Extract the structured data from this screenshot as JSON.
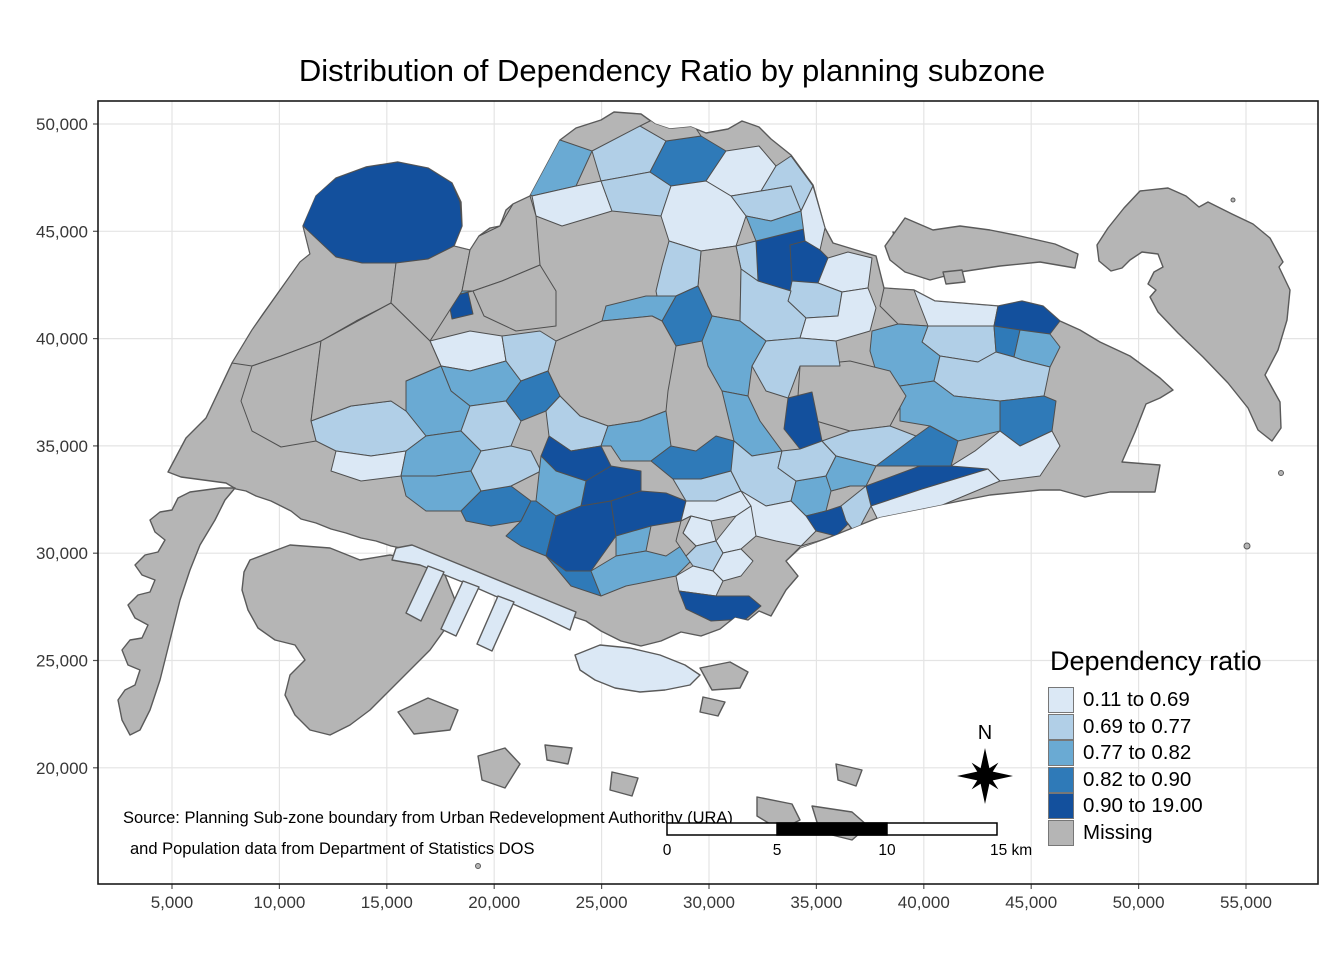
{
  "title": "Distribution of Dependency Ratio by planning subzone",
  "axes": {
    "x_ticks": [
      "5,000",
      "10,000",
      "15,000",
      "20,000",
      "25,000",
      "30,000",
      "35,000",
      "40,000",
      "45,000",
      "50,000",
      "55,000"
    ],
    "y_ticks": [
      "50,000",
      "45,000",
      "40,000",
      "35,000",
      "30,000",
      "25,000",
      "20,000"
    ]
  },
  "legend": {
    "title": "Dependency ratio",
    "items": [
      {
        "label": "0.11 to 0.69",
        "color": "#dbe8f5"
      },
      {
        "label": "0.69 to 0.77",
        "color": "#b1cfe7"
      },
      {
        "label": "0.77 to 0.82",
        "color": "#6aaad3"
      },
      {
        "label": "0.82 to 0.90",
        "color": "#2f7ab8"
      },
      {
        "label": "0.90 to 19.00",
        "color": "#13509d"
      },
      {
        "label": "Missing",
        "color": "#b5b5b5"
      }
    ]
  },
  "annotations": {
    "source_line1": "Source: Planning Sub-zone boundary from Urban Redevelopment Authorithy (URA)",
    "source_line2": "and Population data from Department of Statistics DOS",
    "north_label": "N",
    "scalebar_labels": [
      "0",
      "5",
      "10",
      "15 km"
    ]
  },
  "map": {
    "palette": {
      "c1": "#dbe8f5",
      "c2": "#b1cfe7",
      "c3": "#6aaad3",
      "c4": "#2f7ab8",
      "c5": "#13509d",
      "na": "#b5b5b5"
    },
    "land_stroke": "#5a5a5a",
    "subzone_stroke": "#4f4f4f",
    "grid_color": "#e4e4e4",
    "border_color": "#1a1a1a",
    "islands": [
      {
        "name": "main-island",
        "c": "na",
        "p": "168,472 186,438 206,418 232,363 252,330 263,314 300,262 310,254 303,226 316,196 336,178 366,167 398,162 428,168 452,183 461,202 462,226 454,246 470,250 479,236 490,228 500,226 506,210 513,204 530,196 560,140 576,128 601,120 614,112 641,114 655,124 670,129 691,127 706,133 728,129 742,121 759,127 771,139 791,155 813,185 825,228 833,243 856,250 876,256 884,288 914,290 935,301 998,306 1022,301 1043,306 1060,321 1080,330 1100,342 1130,356 1160,378 1173,390 1160,398 1146,404 1135,432 1122,462 1160,465 1155,492 1110,492 1085,497 1060,490 1040,490 990,495 940,505 880,517 830,537 800,548 786,561 798,576 786,590 771,616 759,611 748,620 735,617 720,629 701,636 681,632 661,641 641,646 621,641 601,631 586,621 571,616 556,606 541,601 526,599 511,591 496,586 481,579 466,573 451,569 436,561 421,556 406,549 391,546 376,541 361,538 346,533 331,529 316,523 301,519 291,511 281,506 271,501 256,496 246,491 236,489 226,483 211,481 196,479 181,477"
      },
      {
        "name": "tuas",
        "c": "na",
        "p": "235,488 220,488 205,490 190,492 178,498 172,510 160,512 150,520 155,532 165,540 158,552 145,555 135,565 142,575 155,580 150,592 138,595 128,605 135,618 148,625 142,638 130,640 122,650 128,665 140,670 135,685 125,690 118,700 122,720 130,735 140,730 150,710 160,680 170,640 180,600 190,570 200,545 215,520 225,500"
      },
      {
        "name": "jurong-island",
        "c": "na",
        "p": "250,560 290,545 330,548 360,560 390,555 420,560 445,575 455,600 448,625 430,650 410,670 390,690 370,710 350,725 330,735 310,730 295,715 285,695 290,675 305,660 295,645 275,640 258,628 248,610 242,590 244,572"
      },
      {
        "name": "sentosa",
        "c": "c1",
        "p": "575,655 600,645 630,648 660,655 685,665 700,675 690,685 665,690 640,692 615,688 595,680 580,670"
      },
      {
        "name": "pier-spine",
        "c": "c1",
        "p": "396,548 412,545 576,612 570,630 545,618 470,585 420,565 392,560"
      },
      {
        "name": "pier-1",
        "c": "c1",
        "p": "428,566 444,572 421,621 406,613"
      },
      {
        "name": "pier-2",
        "c": "c1",
        "p": "463,581 479,587 456,636 441,629"
      },
      {
        "name": "pier-3",
        "c": "c1",
        "p": "498,596 514,602 492,651 477,644"
      },
      {
        "name": "coney",
        "c": "na",
        "p": "893,232 933,247 926,256 896,243"
      },
      {
        "name": "pulau-ubin",
        "c": "na",
        "p": "885,246 905,218 933,230 960,226 990,230 1020,236 1055,244 1078,254 1075,268 1040,262 1000,266 960,272 930,280 905,272 890,260"
      },
      {
        "name": "ubin-islet",
        "c": "na",
        "p": "943,272 962,270 965,282 946,284"
      },
      {
        "name": "pulau-tekong",
        "c": "na",
        "p": "1140,191 1168,188 1186,196 1199,207 1208,202 1232,214 1253,224 1270,238 1283,262 1279,267 1290,290 1287,320 1278,350 1265,375 1280,402 1281,428 1272,441 1258,430 1248,408 1228,383 1203,357 1178,333 1158,312 1150,297 1156,290 1148,284 1154,272 1163,267 1158,254 1142,252 1130,260 1122,268 1111,271 1099,261 1097,245 1108,228 1124,208"
      },
      {
        "name": "south-island-1",
        "c": "na",
        "p": "398,712 428,698 458,710 450,730 414,734"
      },
      {
        "name": "south-island-2",
        "c": "na",
        "p": "478,756 505,748 520,764 505,788 482,780"
      },
      {
        "name": "south-island-3",
        "c": "na",
        "p": "545,745 572,748 568,764 547,760"
      },
      {
        "name": "south-island-4",
        "c": "na",
        "p": "612,772 638,778 632,796 610,790"
      },
      {
        "name": "south-island-5",
        "c": "na",
        "p": "700,668 730,662 748,672 740,688 712,690"
      },
      {
        "name": "south-island-6",
        "c": "na",
        "p": "703,697 725,702 718,716 700,712"
      },
      {
        "name": "south-island-7",
        "c": "na",
        "p": "757,797 792,804 800,820 780,830 757,816"
      },
      {
        "name": "south-island-8",
        "c": "na",
        "p": "812,806 852,812 868,826 852,840 820,832"
      },
      {
        "name": "south-island-9",
        "c": "na",
        "p": "836,764 862,770 856,786 838,780"
      }
    ],
    "islet_dots": [
      {
        "x": 1233,
        "y": 200,
        "r": 2
      },
      {
        "x": 1281,
        "y": 473,
        "r": 2.5
      },
      {
        "x": 1247,
        "y": 546,
        "r": 3
      },
      {
        "x": 478,
        "y": 866,
        "r": 2.5
      }
    ],
    "subzones": [
      {
        "c": "c5",
        "p": "302,228 315,196 336,178 366,167 398,162 428,168 452,183 460,202 462,226 454,246 428,259 396,263 362,263 336,257 316,247"
      },
      {
        "c": "c5",
        "p": "448,298 468,292 473,314 452,319"
      },
      {
        "c": "c3",
        "p": "449,274 470,268 473,291 451,296"
      },
      {
        "c": "c3",
        "p": "506,172 560,140 592,151 576,186 532,196"
      },
      {
        "c": "c2",
        "p": "592,151 640,126 666,141 650,172 601,181"
      },
      {
        "c": "c1",
        "p": "532,196 576,186 601,181 612,211 562,226 536,216"
      },
      {
        "c": "c2",
        "p": "601,181 650,172 671,186 661,216 612,211"
      },
      {
        "c": "c4",
        "p": "650,172 666,141 701,136 726,151 706,181 671,186"
      },
      {
        "c": "na",
        "p": "640,126 660,116 691,121 701,136 666,141"
      },
      {
        "c": "c1",
        "p": "706,181 726,151 759,146 776,166 761,191 731,196"
      },
      {
        "c": "c2",
        "p": "761,191 776,166 791,156 813,186 801,211 791,186"
      },
      {
        "c": "c2",
        "p": "731,196 761,191 791,186 801,211 771,221 746,216"
      },
      {
        "c": "c1",
        "p": "661,216 671,186 706,181 731,196 746,216 736,246 701,251 669,241"
      },
      {
        "c": "c5",
        "p": "756,241 816,226 818,276 791,291 758,281"
      },
      {
        "c": "c3",
        "p": "746,216 771,221 801,211 816,226 756,241"
      },
      {
        "c": "c2",
        "p": "736,246 756,241 758,281 741,269"
      },
      {
        "c": "c1",
        "p": "801,211 813,186 825,228 820,250 805,241"
      },
      {
        "c": "c5",
        "p": "790,245 805,241 820,250 828,258 818,283 792,281"
      },
      {
        "c": "c1",
        "p": "818,283 828,258 848,252 872,258 868,288 842,292"
      },
      {
        "c": "c2",
        "p": "792,281 818,283 842,292 838,316 806,318 788,301"
      },
      {
        "c": "na",
        "p": "701,251 736,246 741,269 740,321 712,316 698,286"
      },
      {
        "c": "c2",
        "p": "740,321 741,269 758,281 791,291 788,301 806,318 800,338 766,341"
      },
      {
        "c": "c1",
        "p": "806,318 838,316 842,292 868,288 876,308 870,331 836,341 800,338"
      },
      {
        "c": "na",
        "p": "884,288 914,290 935,301 928,326 898,324 880,306"
      },
      {
        "c": "c1",
        "p": "914,290 935,301 998,306 994,326 928,326"
      },
      {
        "c": "c5",
        "p": "998,306 1022,301 1043,306 1060,321 1050,334 1020,330 994,326"
      },
      {
        "c": "c2",
        "p": "928,326 994,326 996,352 978,362 940,356 922,342"
      },
      {
        "c": "c4",
        "p": "994,326 1020,330 1014,357 996,352"
      },
      {
        "c": "c3",
        "p": "1020,330 1050,334 1060,347 1050,367 1022,360 1014,357"
      },
      {
        "c": "c3",
        "p": "898,324 928,326 922,342 940,356 934,381 900,386 876,371 870,351 872,331"
      },
      {
        "c": "c2",
        "p": "940,356 978,362 996,352 1014,357 1022,360 1050,367 1044,396 1000,401 954,396 934,381"
      },
      {
        "c": "c3",
        "p": "934,381 954,396 1000,401 1000,431 958,441 930,426 900,421 900,386"
      },
      {
        "c": "c4",
        "p": "1000,401 1044,396 1056,401 1052,431 1020,446 1000,431"
      },
      {
        "c": "na",
        "p": "800,366 850,361 890,371 906,396 890,426 850,431 816,421 798,396"
      },
      {
        "c": "c5",
        "p": "788,398 812,392 822,441 800,449 784,429"
      },
      {
        "c": "c2",
        "p": "766,341 800,338 836,341 840,366 800,366 788,398 766,391 752,366"
      },
      {
        "c": "c3",
        "p": "712,316 740,321 766,341 752,366 748,396 722,391 708,366 702,341"
      },
      {
        "c": "c3",
        "p": "722,391 748,396 760,421 782,451 752,456 734,441"
      },
      {
        "c": "c2",
        "p": "669,241 701,251 698,286 676,296 662,321 656,291 662,266"
      },
      {
        "c": "c4",
        "p": "676,296 698,286 712,316 702,341 676,346 662,321"
      },
      {
        "c": "c3",
        "p": "606,306 646,296 676,296 662,321 652,316 602,321"
      },
      {
        "c": "na",
        "p": "556,341 602,321 652,316 662,321 676,346 668,391 666,411 640,421 608,426 580,416 560,396 548,371"
      },
      {
        "c": "c1",
        "p": "430,341 470,331 502,336 506,361 470,371 441,366"
      },
      {
        "c": "c3",
        "p": "441,366 470,371 506,361 521,381 506,401 470,406 451,391"
      },
      {
        "c": "c2",
        "p": "502,336 540,331 556,341 548,371 521,381 506,361"
      },
      {
        "c": "c3",
        "p": "406,381 441,366 451,391 470,406 461,431 426,436 406,411"
      },
      {
        "c": "c2",
        "p": "461,431 470,406 506,401 521,421 511,446 481,451"
      },
      {
        "c": "c4",
        "p": "521,381 548,371 560,396 546,411 521,421 506,401"
      },
      {
        "c": "c2",
        "p": "311,421 351,406 391,401 406,411 426,436 406,451 371,456 336,451 316,441"
      },
      {
        "c": "c1",
        "p": "336,451 371,456 406,451 401,476 361,481 331,471"
      },
      {
        "c": "c3",
        "p": "406,451 426,436 461,431 481,451 471,471 436,476 401,476"
      },
      {
        "c": "c3",
        "p": "401,476 436,476 471,471 481,491 461,511 426,511 406,496"
      },
      {
        "c": "c4",
        "p": "461,511 481,491 511,486 531,501 521,521 491,526 466,521"
      },
      {
        "c": "c2",
        "p": "481,451 511,446 531,451 541,471 511,486 481,491 471,471"
      },
      {
        "c": "c2",
        "p": "546,411 560,396 580,416 608,426 601,446 571,451 549,436"
      },
      {
        "c": "c5",
        "p": "549,436 571,451 601,446 611,466 586,481 556,471 541,456"
      },
      {
        "c": "c3",
        "p": "608,426 640,421 666,411 671,446 651,461 621,461 611,446 601,446"
      },
      {
        "c": "c5",
        "p": "586,481 611,466 641,471 641,491 611,501 581,506"
      },
      {
        "c": "c3",
        "p": "541,456 556,471 586,481 581,506 556,516 536,501"
      },
      {
        "c": "c4",
        "p": "531,501 536,501 556,516 546,556 521,546 506,536 521,521"
      },
      {
        "c": "c5",
        "p": "556,516 581,506 611,501 616,536 591,571 566,571 546,556"
      },
      {
        "c": "c5",
        "p": "611,501 641,491 666,493 686,501 681,521 651,526 616,536"
      },
      {
        "c": "c3",
        "p": "616,536 651,526 646,551 616,556"
      },
      {
        "c": "c4",
        "p": "546,556 566,571 591,571 601,596 571,586"
      },
      {
        "c": "c3",
        "p": "591,571 616,556 646,551 666,556 681,546 691,561 676,576 651,581 626,586 601,596"
      },
      {
        "c": "c4",
        "p": "651,461 671,446 696,451 716,436 734,441 752,456 731,471 701,479 673,479"
      },
      {
        "c": "c2",
        "p": "673,479 701,479 731,471 741,491 716,501 686,501"
      },
      {
        "c": "c1",
        "p": "686,501 716,501 741,491 751,506 736,516 711,521 691,516 681,521"
      },
      {
        "c": "c1",
        "p": "691,516 711,521 716,541 696,546 683,533"
      },
      {
        "c": "c1",
        "p": "716,541 736,516 751,506 766,516 756,536 741,549 723,553"
      },
      {
        "c": "c2",
        "p": "696,546 716,541 723,553 713,571 693,566 686,556"
      },
      {
        "c": "c1",
        "p": "713,571 723,553 741,549 753,561 741,576 723,581"
      },
      {
        "c": "na",
        "p": "681,521 691,516 683,533 696,546 686,556 676,541"
      },
      {
        "c": "c1",
        "p": "676,576 693,566 713,571 723,581 716,596 679,591"
      },
      {
        "c": "c5",
        "p": "679,591 716,596 749,596 761,606 746,619 711,621 686,609"
      },
      {
        "c": "c2",
        "p": "731,471 734,441 752,456 782,451 778,468 796,481 791,501 766,506 741,491"
      },
      {
        "c": "c3",
        "p": "796,481 826,476 836,456 856,461 850,486 831,491 826,511 806,516 791,501"
      },
      {
        "c": "c5",
        "p": "806,516 826,511 841,506 851,521 836,536 816,531"
      },
      {
        "c": "c1",
        "p": "741,491 766,506 791,501 806,516 816,531 801,546 776,541 756,536 751,506"
      },
      {
        "c": "na",
        "p": "786,561 801,546 836,536 846,551 828,569 798,576"
      },
      {
        "c": "c2",
        "p": "782,451 800,449 822,441 836,456 826,476 796,481 778,468"
      },
      {
        "c": "c2",
        "p": "822,441 850,431 890,426 916,436 911,461 876,466 836,456"
      },
      {
        "c": "c3",
        "p": "836,456 876,466 866,486 850,486 831,491 826,476"
      },
      {
        "c": "c4",
        "p": "876,466 916,436 930,426 958,441 951,466 920,466"
      },
      {
        "c": "c5",
        "p": "866,486 920,466 951,466 975,451 988,469 922,489 871,506"
      },
      {
        "c": "c2",
        "p": "841,506 866,486 871,506 856,534 846,521"
      },
      {
        "c": "c5",
        "p": "846,521 856,534 908,511 918,521 860,541"
      },
      {
        "c": "c1",
        "p": "871,506 922,489 988,469 1000,481 940,506 880,524"
      },
      {
        "c": "c1",
        "p": "951,466 975,451 1000,431 1020,446 1052,431 1060,446 1040,476 1000,481 988,469"
      },
      {
        "c": "na",
        "p": "232,363 252,330 300,262 310,254 303,226 336,257 362,263 396,263 391,303 356,321 321,341 281,356 252,366"
      },
      {
        "c": "na",
        "p": "252,366 281,356 321,341 311,421 316,441 281,447 252,431 241,401"
      },
      {
        "c": "na",
        "p": "396,263 428,259 454,246 470,250 462,291 430,341 391,303"
      },
      {
        "c": "na",
        "p": "470,250 479,236 500,226 513,204 530,196 536,216 540,265 502,281 473,291 462,291"
      },
      {
        "c": "na",
        "p": "473,291 502,281 540,265 556,291 556,326 516,331 484,316"
      },
      {
        "c": "na",
        "p": "321,341 391,303 430,341 441,366 406,381 406,411 391,401 351,406 311,421"
      }
    ]
  }
}
